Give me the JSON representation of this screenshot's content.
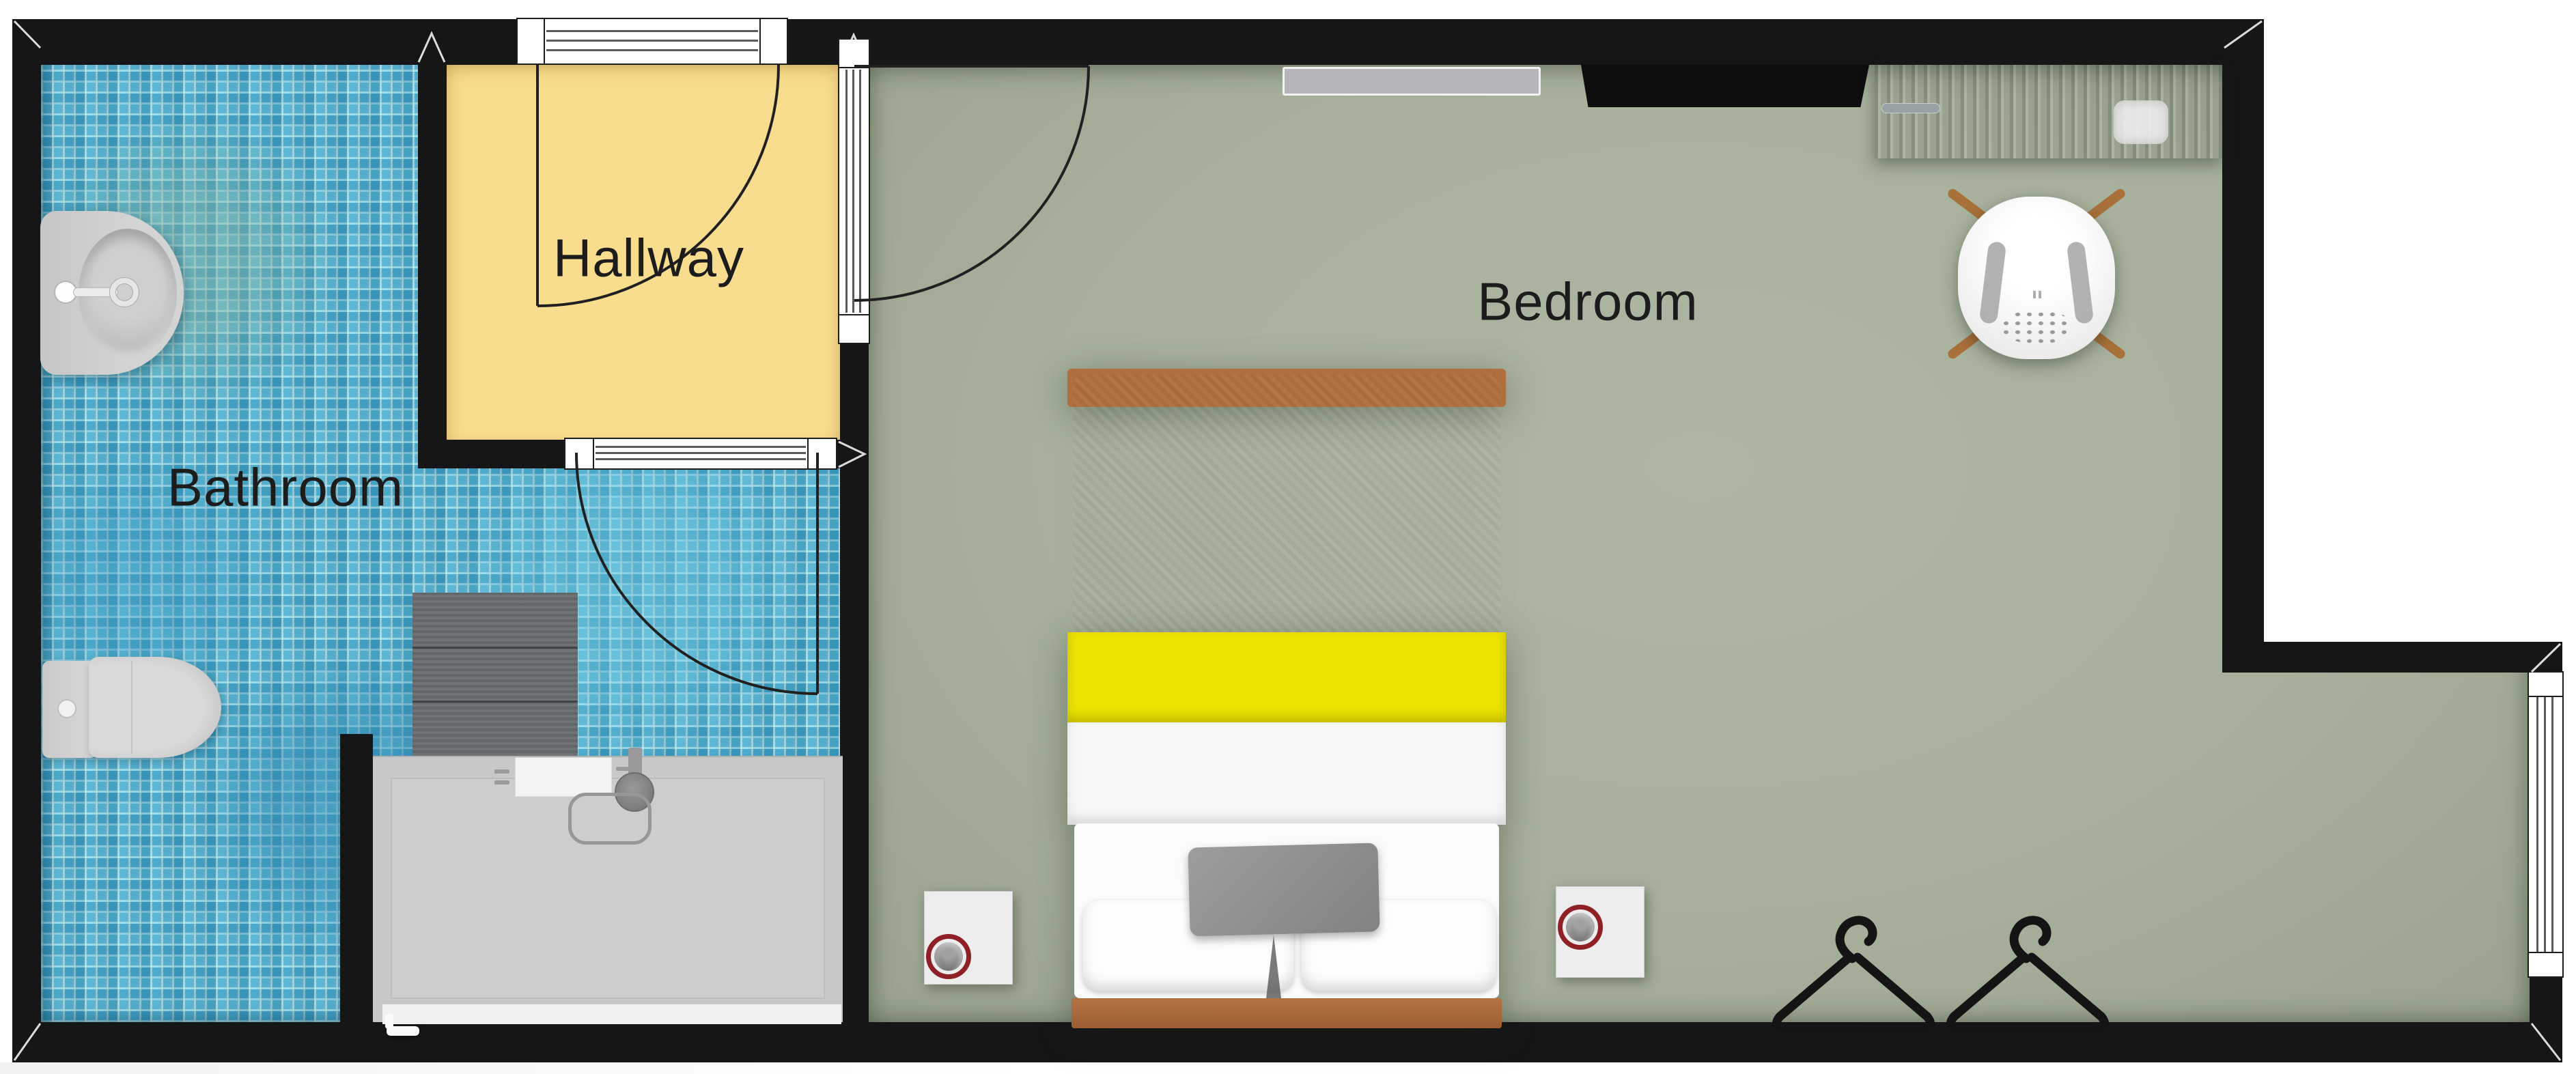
{
  "document": {
    "type": "floor-plan-top-view"
  },
  "rooms": {
    "bathroom": {
      "label": "Bathroom"
    },
    "hallway": {
      "label": "Hallway"
    },
    "bedroom": {
      "label": "Bedroom"
    }
  },
  "colors": {
    "wall": "#161616",
    "bathroom_tile": "#45a7c9",
    "hallway_floor": "#f8dd8e",
    "bedroom_floor": "#a6b09b",
    "bed_duvet": "#8a8a8a",
    "bed_stripe": "#ece300",
    "bed_sheet": "#f7f7f7",
    "bed_wood": "#b06f3f",
    "desk_wood": "#5d3d2b",
    "chair_leg_wood": "#a9713a",
    "device_ring": "#8f2026",
    "shower_tray": "#c8c8c8",
    "mat": "#686c6f",
    "radiator": "#b6b6ba",
    "tv": "#0e0e0e"
  },
  "furniture": {
    "bathroom": [
      "pedestal-sink",
      "wall-hung-toilet",
      "bath-mat",
      "walk-in-shower"
    ],
    "bedroom": [
      "double-bed",
      "nightstand-left",
      "nightstand-right",
      "smart-button-left",
      "smart-button-right",
      "wall-radiator",
      "wall-tv",
      "desk",
      "desk-chair",
      "clothes-hanger-1",
      "clothes-hanger-2"
    ]
  },
  "openings": {
    "entrance_door": "top-wall-into-hallway",
    "bathroom_door": "hallway-to-bathroom",
    "bedroom_door": "hallway-to-bedroom",
    "bedroom_window": "right-wall"
  }
}
